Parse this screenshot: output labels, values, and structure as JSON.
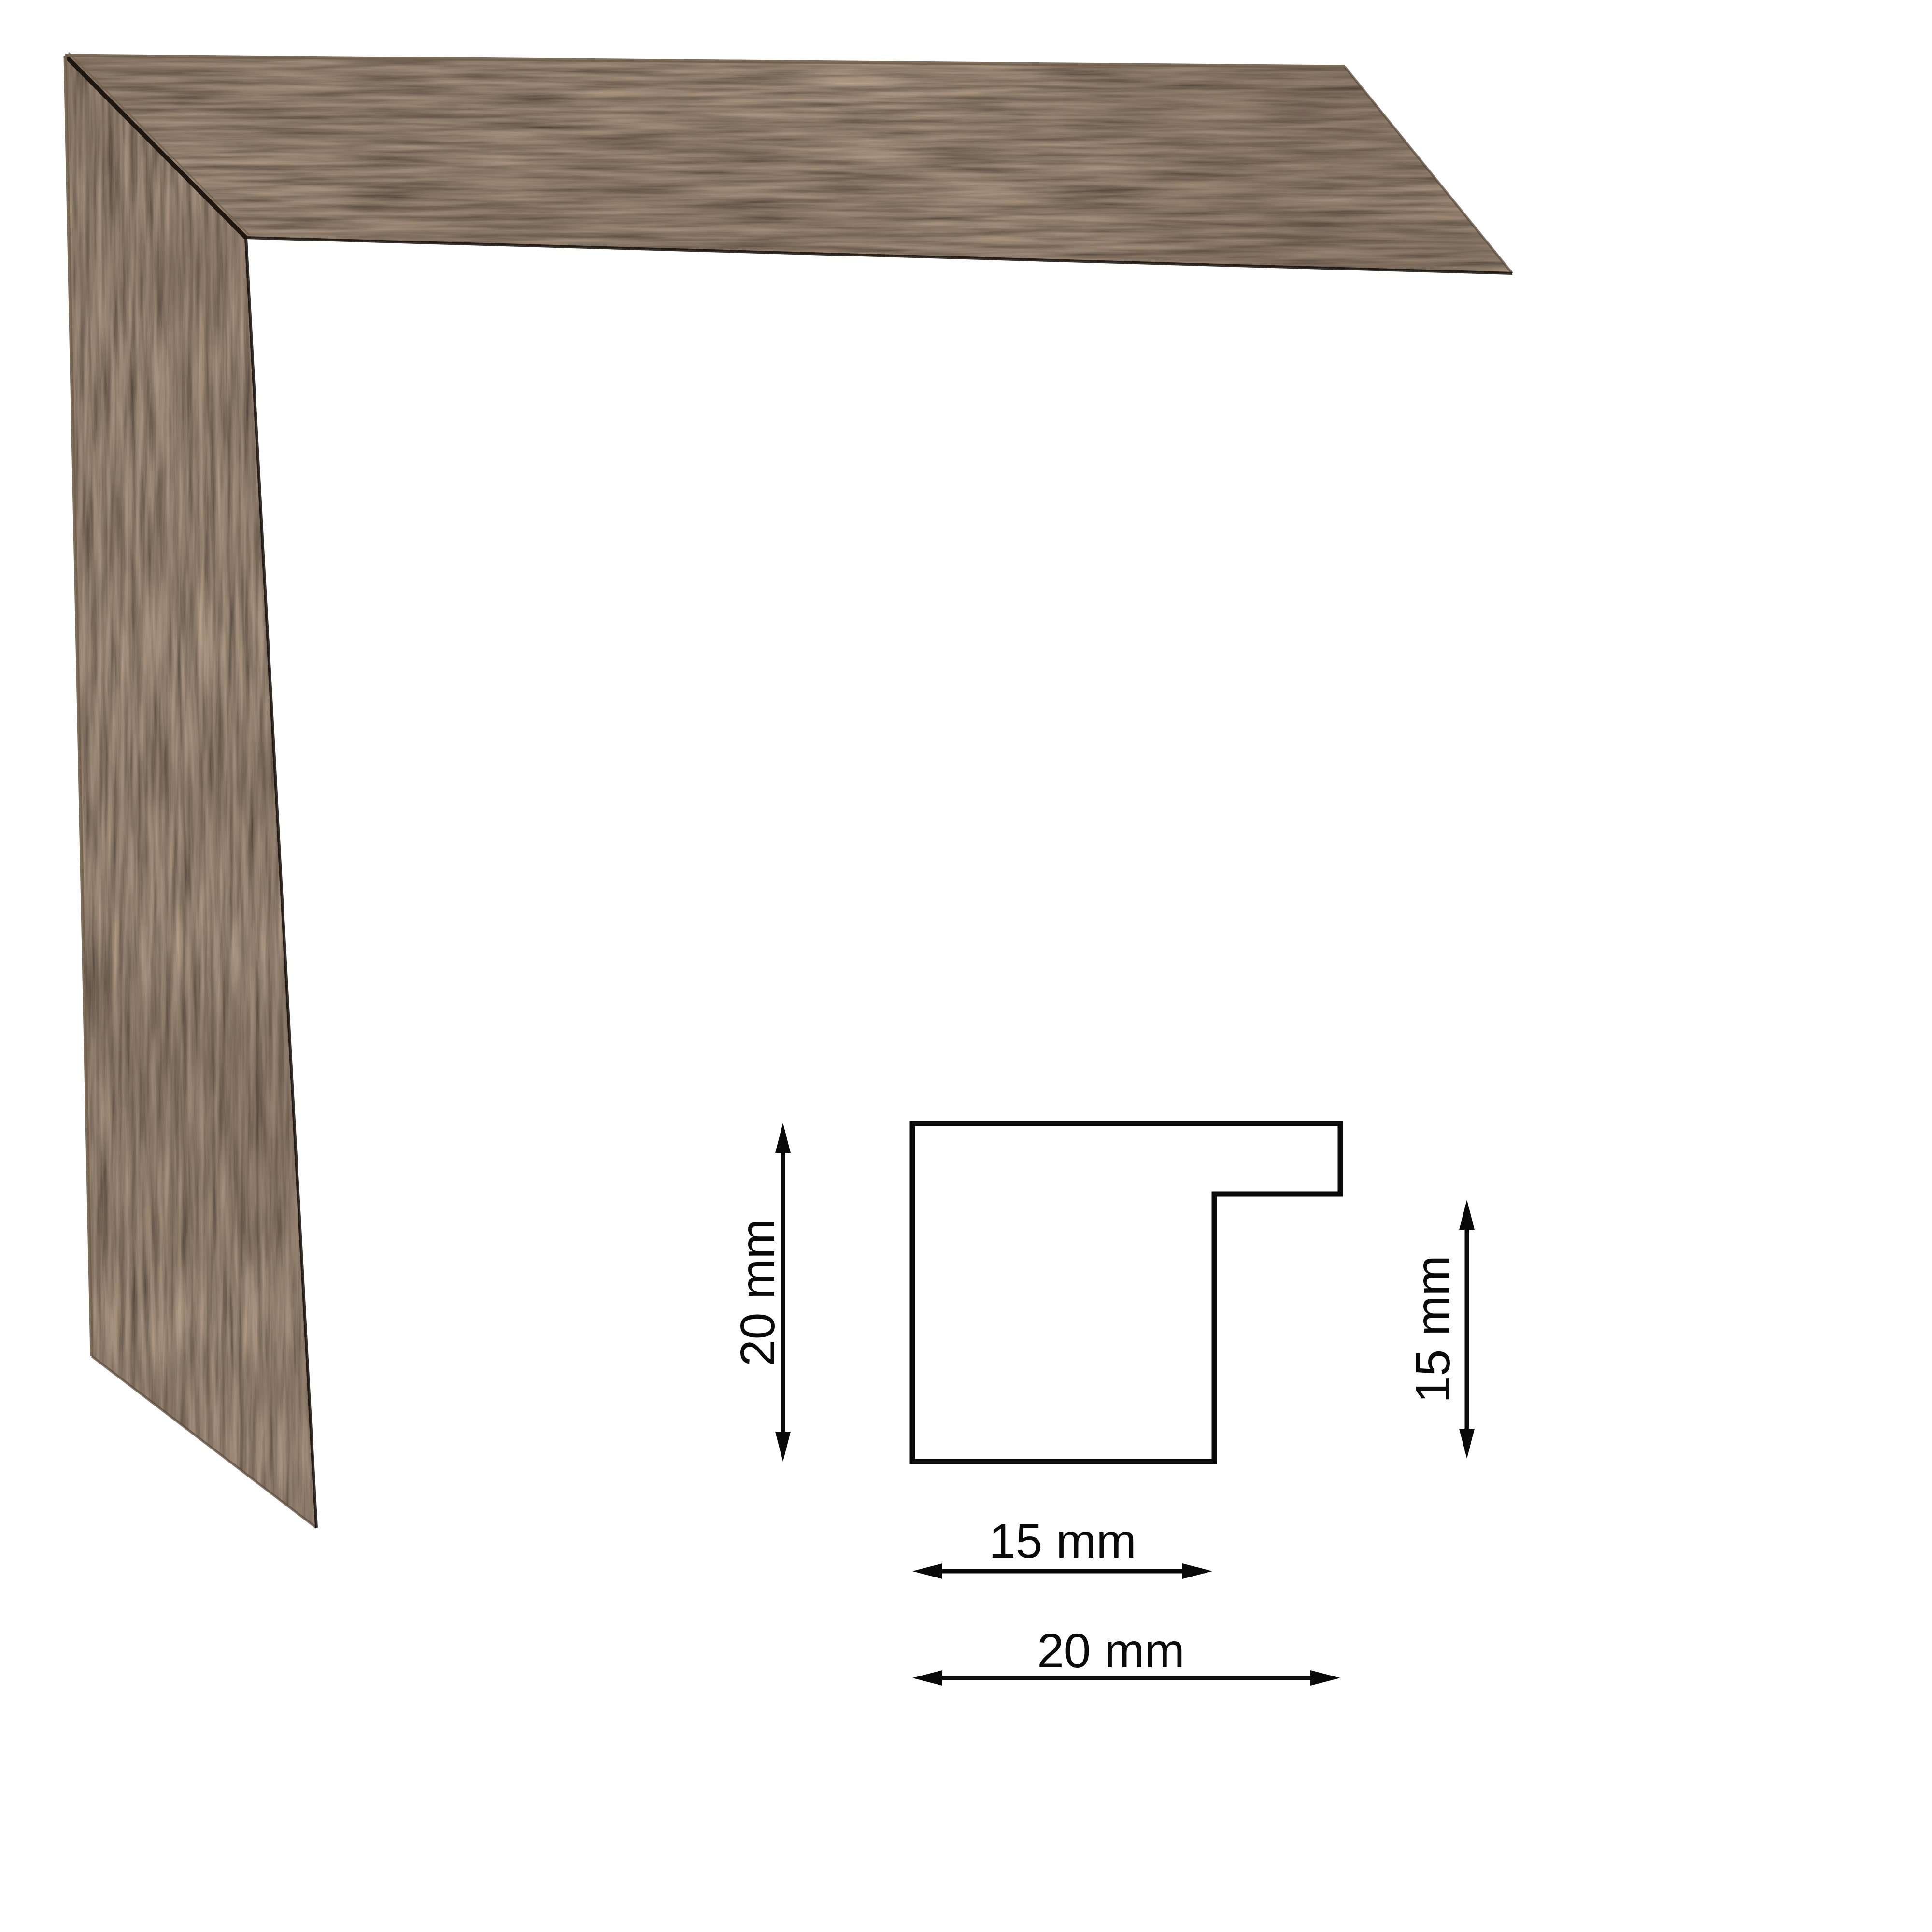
{
  "page": {
    "background_color": "#ffffff"
  },
  "frame_sample": {
    "wood_base_color": "#3a2e23",
    "wood_dark_streak_color": "#20180f",
    "wood_highlight_color": "#71604b"
  },
  "profile_diagram": {
    "line_color": "#0a0a0a",
    "labels": {
      "height_left": "20 mm",
      "height_right": "15 mm",
      "width_inner": "15 mm",
      "width_outer": "20 mm"
    }
  }
}
